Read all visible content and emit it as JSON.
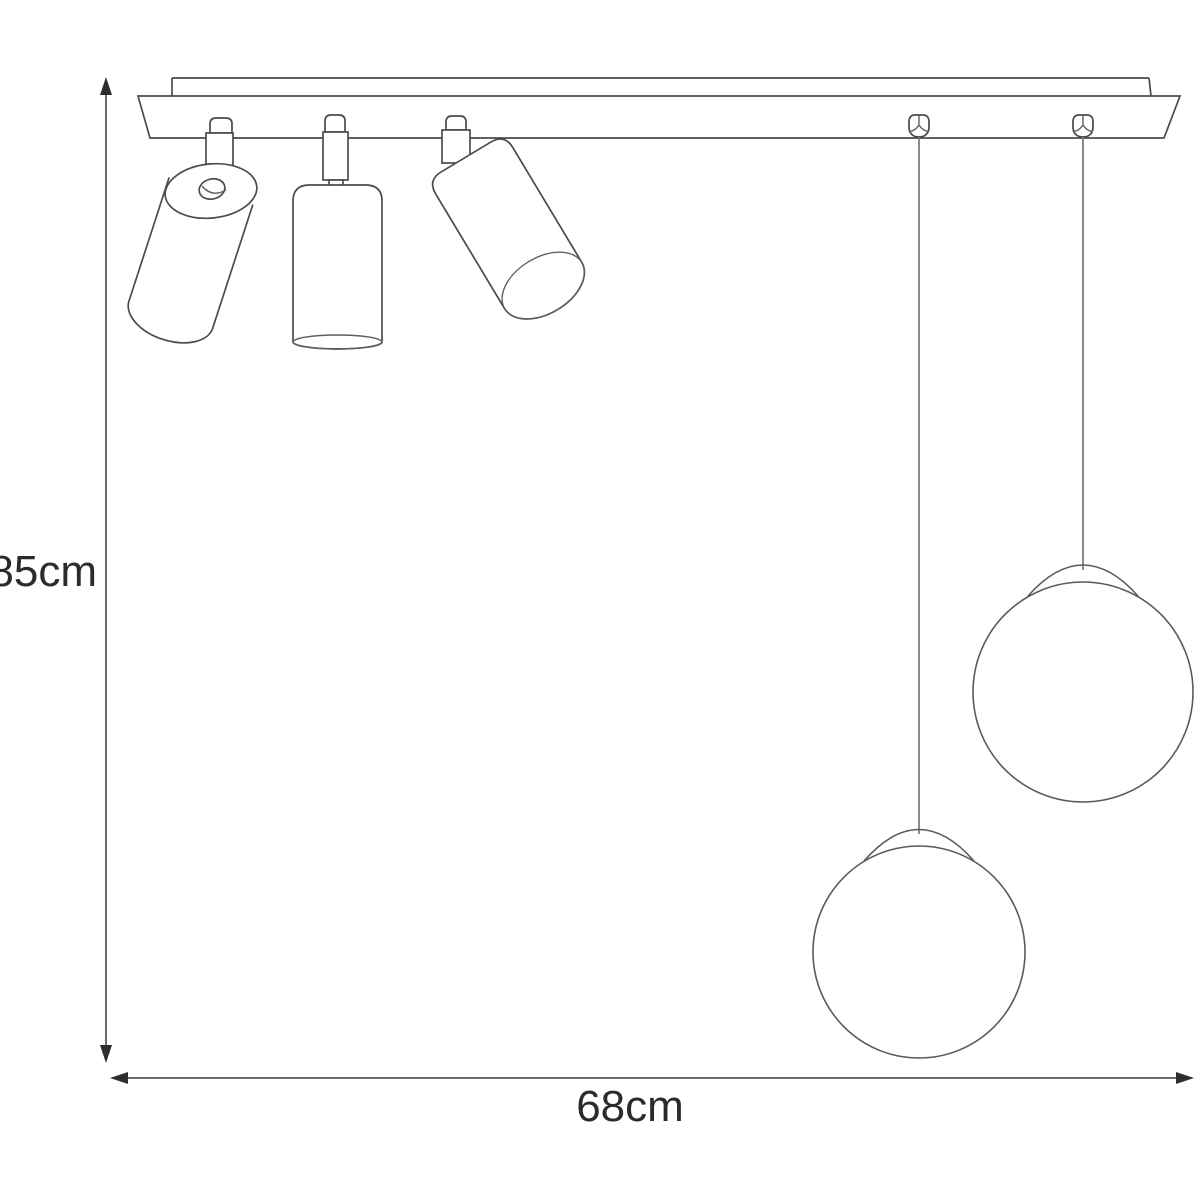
{
  "diagram": {
    "type": "ceiling lamp dimension drawing: mounting bar with three adjustable spotlights and two suspended globe pendants",
    "dimensions": {
      "height_label": "85cm",
      "width_label": "68cm"
    },
    "components": [
      "ceiling mounting bar",
      "spotlight tilted left",
      "spotlight vertical",
      "spotlight tilted right",
      "cable gland left",
      "cable gland right",
      "suspension wire long",
      "suspension wire short",
      "globe pendant lower",
      "globe pendant upper"
    ],
    "colors": {
      "line": "#4b4b4b",
      "dimension_line": "#3a3a3a",
      "text": "#2b2b2b",
      "background": "#ffffff"
    }
  }
}
